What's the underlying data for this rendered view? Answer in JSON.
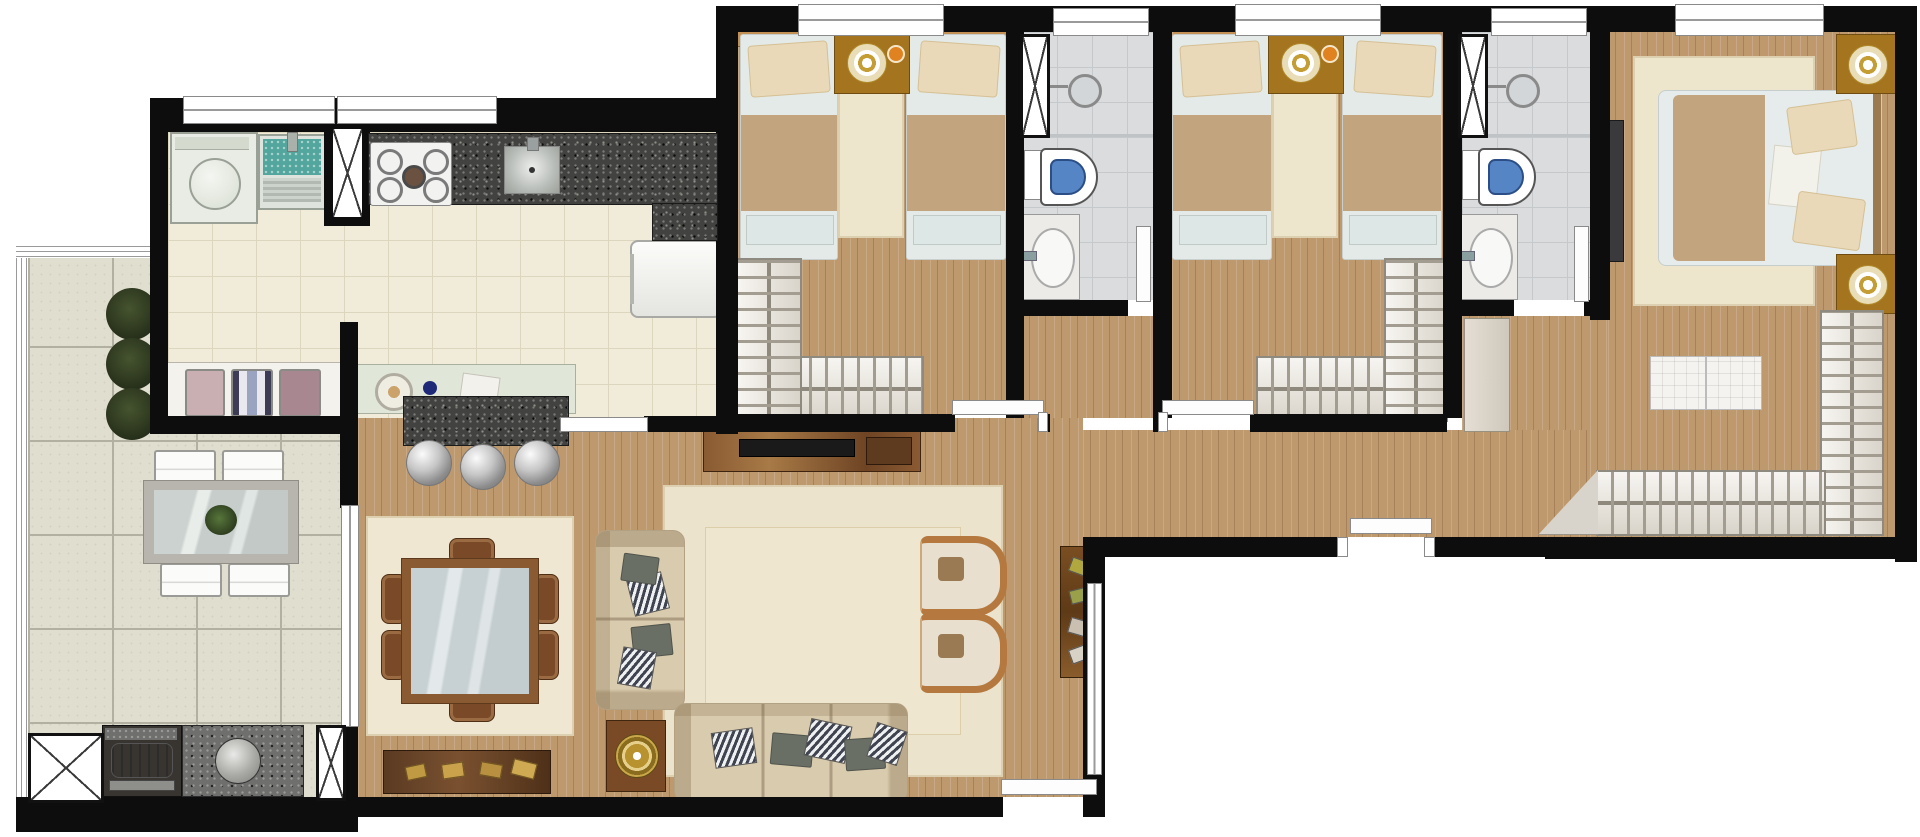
{
  "app": {
    "type": "architectural-floor-plan",
    "description": "Top-down 3D rendered apartment floor plan, no text labels visible"
  },
  "palette": {
    "wall": "#0d0d0d",
    "wood_floor": "#bf996e",
    "kitchen_tile": "#f1ecd9",
    "terrace_tile": "#e0decf",
    "bathroom_tile": "#dadcde",
    "granite_dark": "#424240",
    "granite_light": "#6f6f6d",
    "rug_cream": "#efe7d1",
    "sofa_beige": "#d9cbae",
    "accent_wood": "#8a5a32",
    "laundry_water_teal": "#53a69e",
    "toilet_seat_blue": "#5585c5",
    "lamp_gold": "#c59d35",
    "plant_green": "#2f3b25",
    "blanket_tan": "#c2a57e"
  },
  "rooms": [
    {
      "id": "terrace",
      "name": "Terrace / Gourmet Balcony",
      "furniture": [
        "outdoor dining table with glass top",
        "4 white chairs",
        "3 round planter shrubs",
        "barbecue grill",
        "granite counter with round sink",
        "elevator shaft marker",
        "perimeter railing"
      ]
    },
    {
      "id": "kitchen",
      "name": "Kitchen & Laundry",
      "furniture": [
        "washing machine",
        "laundry tub",
        "gas cooktop",
        "granite counter with sink",
        "refrigerator",
        "towel shelf",
        "pass-through counter with breakfast bar",
        "3 bar stools"
      ]
    },
    {
      "id": "living",
      "name": "Living / Dining Room",
      "furniture": [
        "glass dining table",
        "6 brown chairs",
        "dining rug",
        "TV sideboard",
        "2-seat sofa",
        "3-seat sofa",
        "round gold side table",
        "2 armchairs",
        "area rug",
        "media console",
        "decor shelf"
      ]
    },
    {
      "id": "hallway",
      "name": "Hallway / Entrance",
      "furniture": [
        "entrance door",
        "linen cabinet"
      ]
    },
    {
      "id": "bedroom1",
      "name": "Bedroom 1 (twin)",
      "furniture": [
        "2 single beds",
        "nightstand with lamp",
        "runner rug",
        "L-shaped wardrobe",
        "door"
      ]
    },
    {
      "id": "bathroom1",
      "name": "Bathroom 1",
      "furniture": [
        "shower",
        "toilet",
        "vanity sink",
        "ventilation shaft",
        "door"
      ]
    },
    {
      "id": "bedroom2",
      "name": "Bedroom 2 (twin)",
      "furniture": [
        "2 single beds",
        "nightstand with lamp",
        "runner rug",
        "L-shaped wardrobe",
        "door"
      ]
    },
    {
      "id": "bathroom2",
      "name": "Bathroom 2",
      "furniture": [
        "shower",
        "toilet",
        "vanity sink",
        "ventilation shaft",
        "door"
      ]
    },
    {
      "id": "master",
      "name": "Master Bedroom",
      "furniture": [
        "double bed",
        "2 nightstands with lamps",
        "area rug",
        "TV panel",
        "tufted ottoman bench",
        "L-shaped wardrobe",
        "window"
      ]
    }
  ]
}
